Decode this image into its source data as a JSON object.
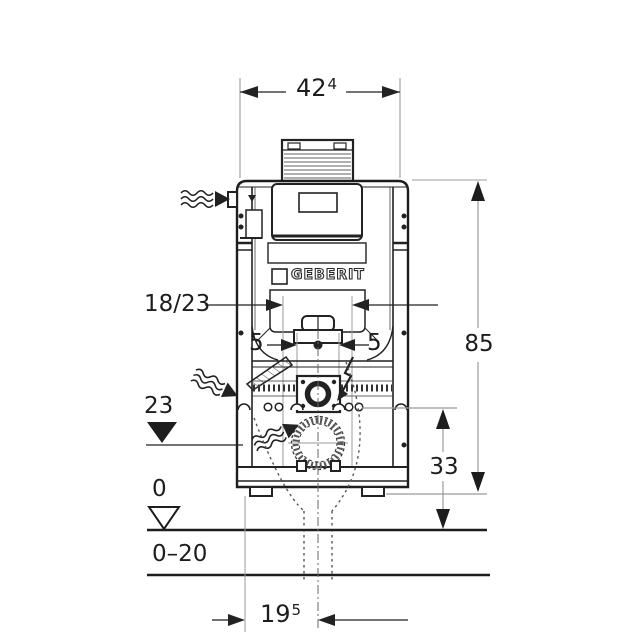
{
  "brand": "GEBERIT",
  "dimensions": {
    "top_width_main": "42",
    "top_width_sup": "4",
    "wall_opening": "18/23",
    "offset_left": "5",
    "offset_right": "5",
    "supply_level": "23",
    "floor_zero": "0",
    "floor_range": "0–20",
    "frame_height": "85",
    "outlet_height": "33",
    "front_depth_main": "19",
    "front_depth_sup": "5"
  },
  "colors": {
    "line": "#1d1d1d",
    "dim_line": "#9b9b9b",
    "background": "#ffffff"
  }
}
